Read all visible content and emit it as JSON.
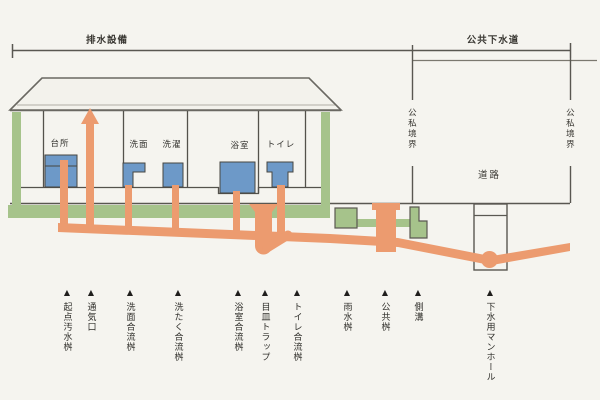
{
  "diagram": {
    "title_left": "排水設備",
    "title_right": "公共下水道",
    "boundary_left": "公私境界",
    "boundary_right": "公私境界",
    "road_label": "道路",
    "rooms": [
      {
        "label": "台所"
      },
      {
        "label": "洗面"
      },
      {
        "label": "洗濯"
      },
      {
        "label": "浴室"
      },
      {
        "label": "トイレ"
      }
    ],
    "legend": {
      "marker": "▲",
      "items": [
        {
          "label": "起点汚水桝"
        },
        {
          "label": "通気口"
        },
        {
          "label": "洗面合流桝"
        },
        {
          "label": "洗たく合流桝"
        },
        {
          "label": "浴室合流桝"
        },
        {
          "label": "目皿トラップ"
        },
        {
          "label": "トイレ合流桝"
        },
        {
          "label": "雨水桝"
        },
        {
          "label": "公共桝"
        },
        {
          "label": "側溝"
        },
        {
          "label": "下水用マンホール"
        }
      ]
    },
    "colors": {
      "pipe_orange": "#ec9b6f",
      "ground_green": "#a6c38b",
      "fixture_blue": "#6d99c8",
      "outline_gray": "#56544e",
      "background": "#f5f4ef"
    }
  }
}
